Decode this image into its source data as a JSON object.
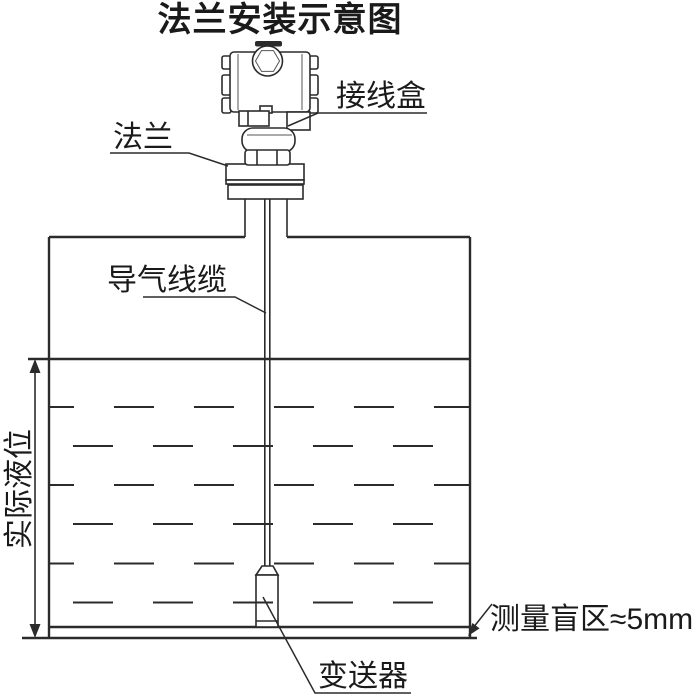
{
  "title": "法兰安装示意图",
  "labels": {
    "junction_box": "接线盒",
    "flange": "法兰",
    "air_cable": "导气线缆",
    "actual_level": "实际液位",
    "transmitter": "变送器",
    "blind_zone": "测量盲区≈5mm"
  },
  "colors": {
    "line": "#2b2b2b",
    "text": "#1a1a1a",
    "background": "#ffffff"
  }
}
